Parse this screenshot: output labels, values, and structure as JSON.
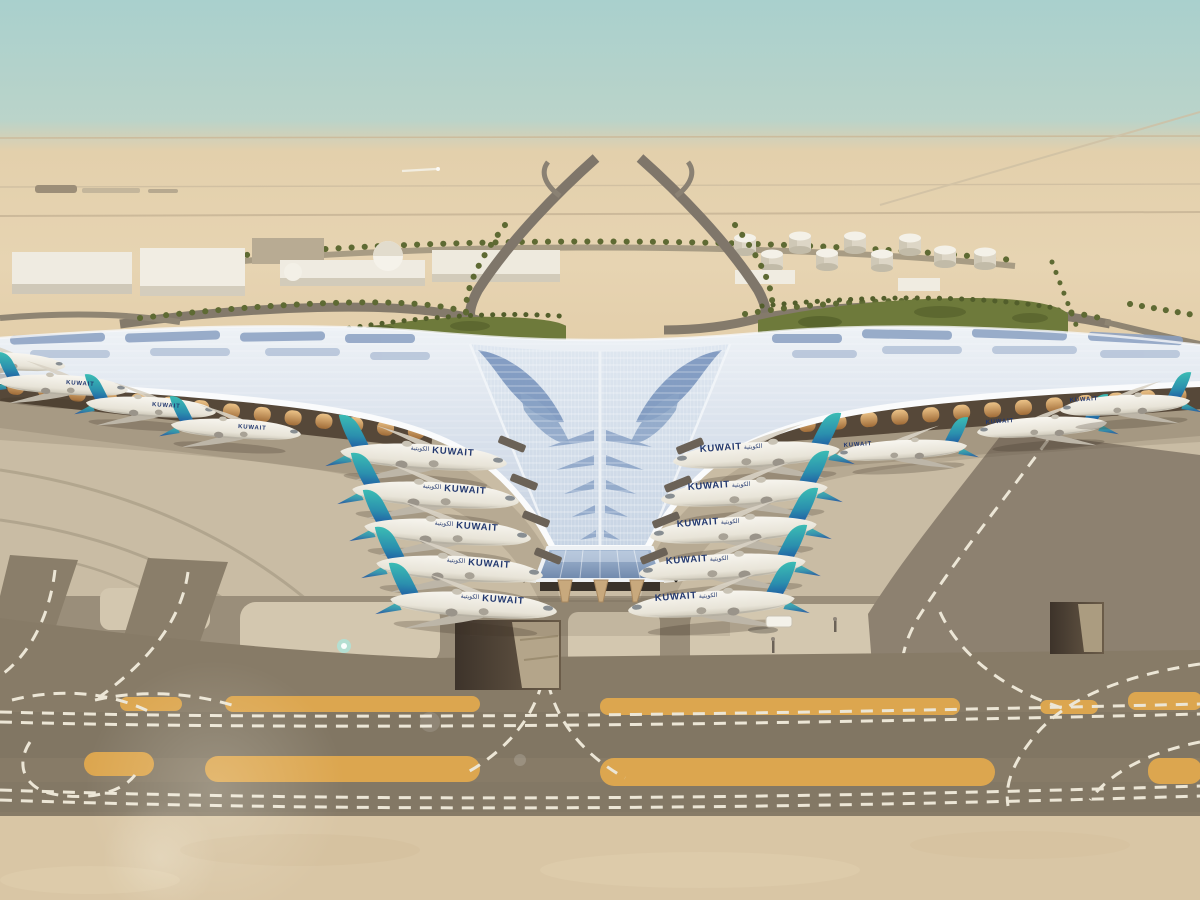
{
  "scene": {
    "description": "Aerial architectural rendering of a Y-shaped desert airport terminal (Kuwait International style) with a sweeping silver trellis roof, blue skylight chevrons, aircraft in Kuwait Airways livery parked on both wings, palm-lined approach roads, white warehouses, domes and fuel tanks in the desert background, and taxiways with orange shoulders and white dashed markings in the foreground",
    "airline": {
      "title": "KUWAIT",
      "title_arabic": "الكويتية"
    },
    "aircraft": {
      "left_main_stands": 5,
      "right_main_stands": 5,
      "left_under_canopy": 4,
      "right_under_canopy": 3,
      "tail_teal": "#3bbcb4",
      "tail_blue": "#1d4f9f",
      "fuselage_color": "#f2efe7",
      "title_color": "#22386f"
    },
    "terminal": {
      "roof_silver": "#dce4ee",
      "skylight_blue": "#7e99c0",
      "entrance_glass": "#8ba4c4",
      "facade_amber": "#d9a455",
      "column_tan": "#c8a97d"
    },
    "ground": {
      "apron": "#c9bca4",
      "taxiway": "#877b67",
      "shoulder_orange": "#dca64f",
      "marking_white": "#ece6d6",
      "sand": "#e5d1ae"
    },
    "environment": {
      "sky_top": "#a9d0cd",
      "sky_horizon": "#ded3bf",
      "vegetation_green": "#6e7a3b",
      "fuel_tanks_count": 9,
      "service_vehicles_count": 1
    }
  }
}
